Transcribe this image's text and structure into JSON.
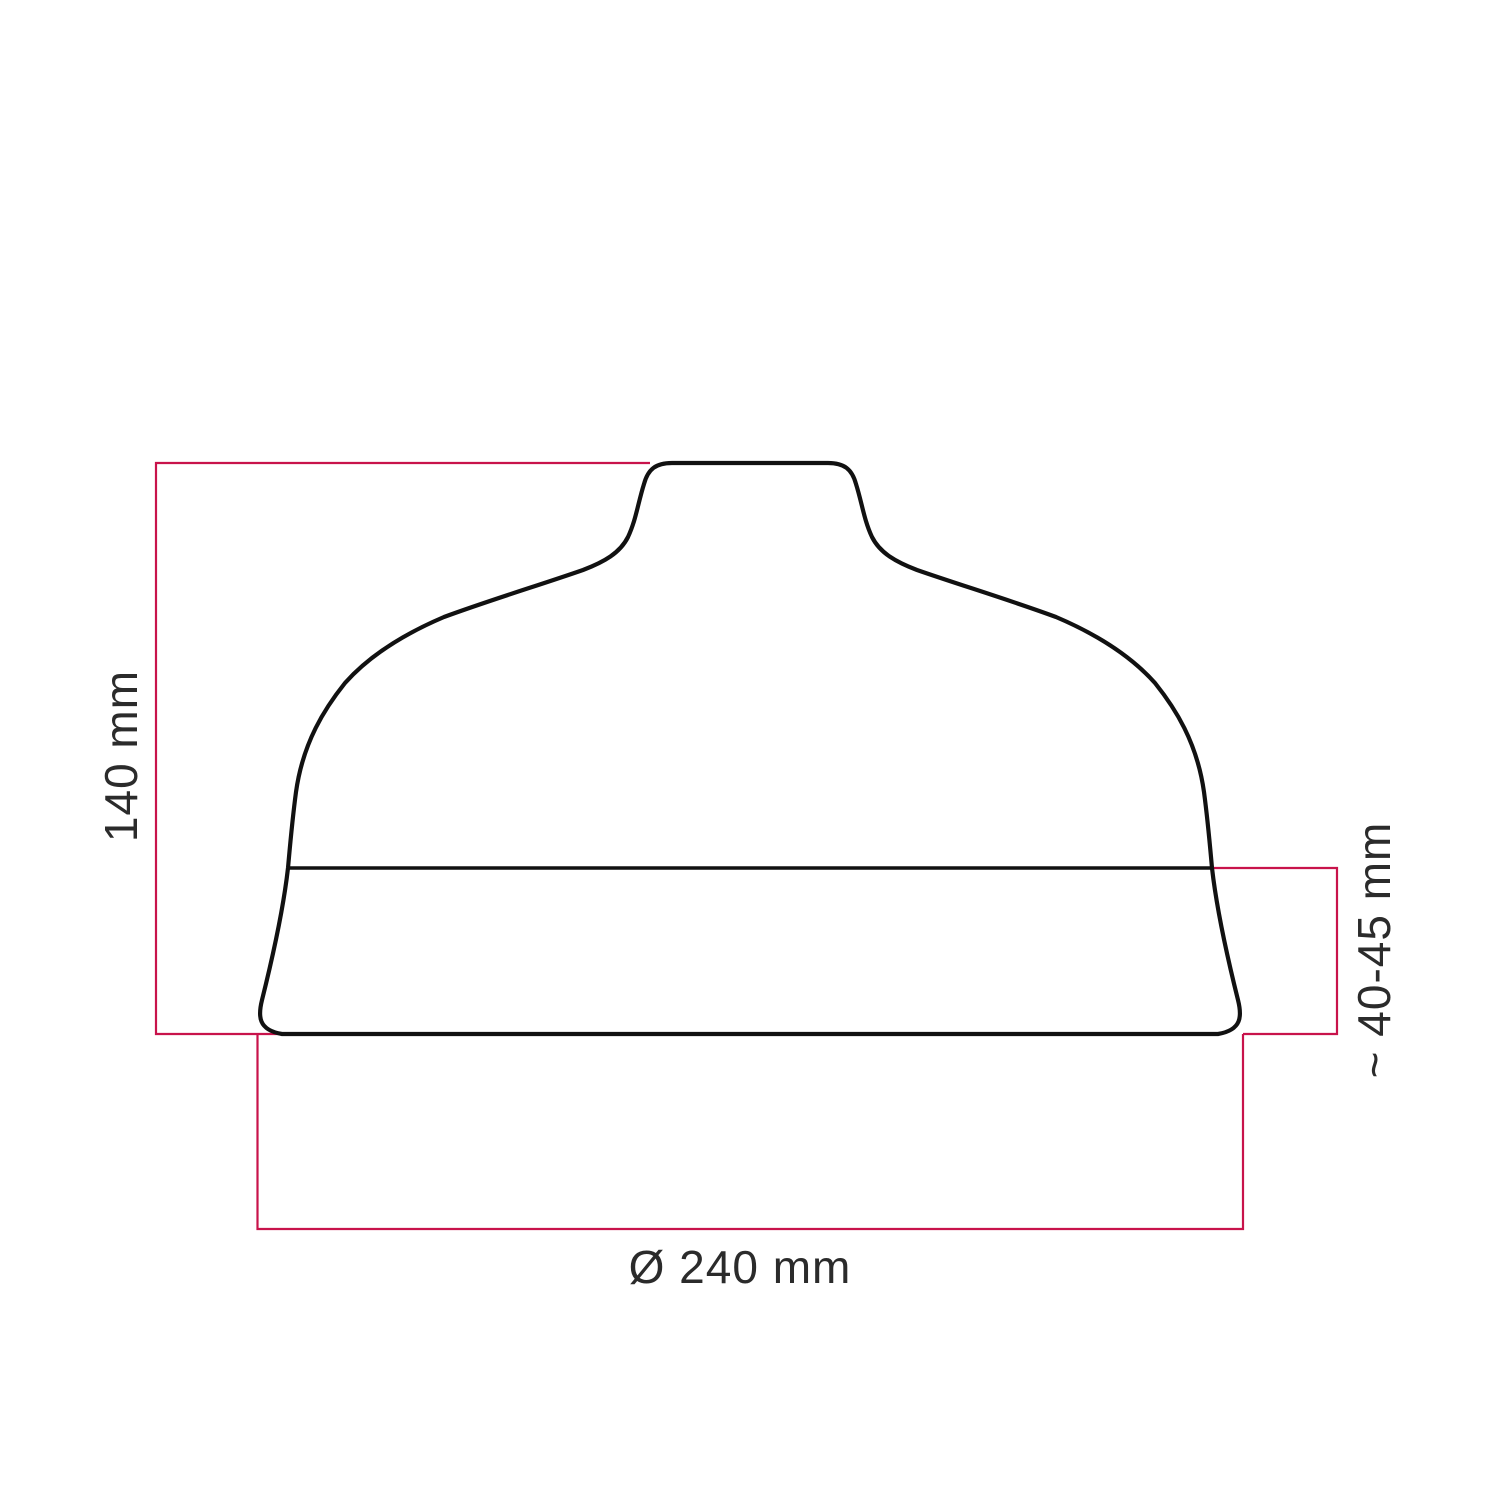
{
  "diagram": {
    "kind": "lampshade-technical-dimension-drawing",
    "colors": {
      "background": "#ffffff",
      "outline": "#111111",
      "dimension": "#c8134b",
      "label": "#2b2b2b"
    },
    "dimensions": {
      "height": {
        "label": "140 mm"
      },
      "lower_section_height": {
        "label": "~ 40-45 mm"
      },
      "diameter": {
        "label": "Ø 240 mm"
      }
    }
  }
}
